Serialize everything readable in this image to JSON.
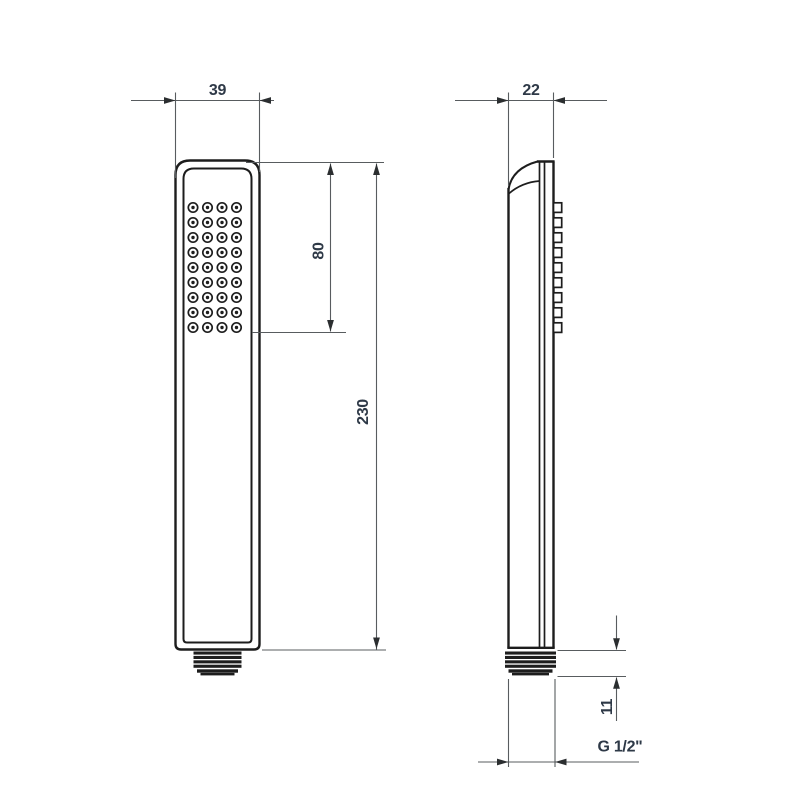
{
  "drawing": {
    "type": "technical-dimension-drawing",
    "subject": "handheld shower head, front and side orthographic views",
    "background": "#ffffff",
    "colors": {
      "object_line": "#1d1d1d",
      "dimension_line": "#585c5f",
      "arrow": "#2b2e30",
      "dim_text": "#2e3947"
    },
    "views": {
      "front": {
        "name": "front-view",
        "nozzle_grid": {
          "rows": 9,
          "cols": 4
        }
      },
      "side": {
        "name": "side-view",
        "nozzle_bumps": 9
      }
    },
    "dimensions": {
      "head_width": "39",
      "spray_face_length": "80",
      "total_length": "230",
      "head_depth": "22",
      "thread_length": "11",
      "thread_spec": "G 1/2\""
    }
  }
}
